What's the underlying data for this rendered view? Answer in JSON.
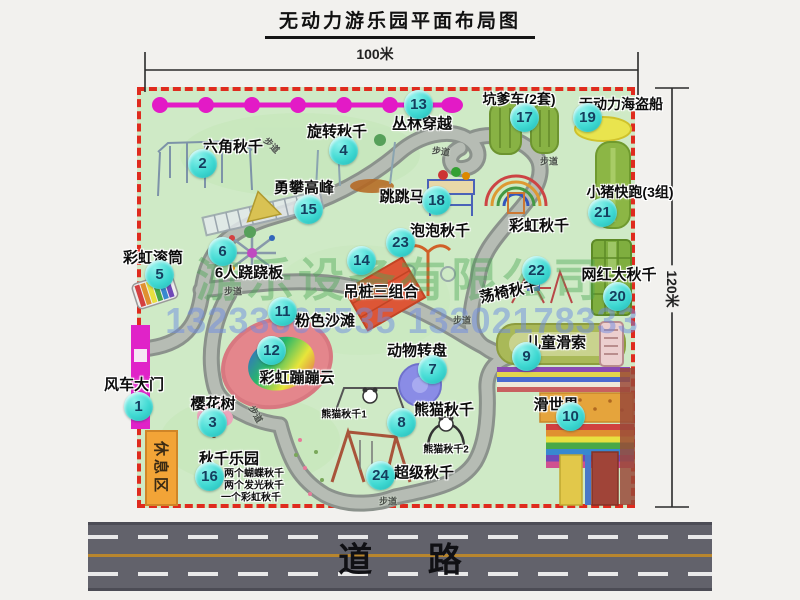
{
  "title": "无动力游乐园平面布局图",
  "dimensions": {
    "width_label": "100米",
    "height_label": "120米"
  },
  "road_label": "道 路",
  "rest_area_label": "休息区",
  "watermark": {
    "company": "游乐设备有限公司",
    "phone": "13233805535 13202178333"
  },
  "attractions": [
    {
      "num": "1",
      "name": "风车大门",
      "bx": 139,
      "by": 407,
      "lx": 134,
      "ly": 384
    },
    {
      "num": "2",
      "name": "六角秋千",
      "bx": 203,
      "by": 164,
      "lx": 233,
      "ly": 146
    },
    {
      "num": "3",
      "name": "樱花树",
      "bx": 213,
      "by": 423,
      "lx": 213,
      "ly": 403
    },
    {
      "num": "4",
      "name": "旋转秋千",
      "bx": 344,
      "by": 151,
      "lx": 337,
      "ly": 131
    },
    {
      "num": "5",
      "name": "彩虹滚筒",
      "bx": 160,
      "by": 275,
      "lx": 153,
      "ly": 257
    },
    {
      "num": "6",
      "name": "6人跷跷板",
      "bx": 223,
      "by": 252,
      "lx": 249,
      "ly": 272
    },
    {
      "num": "7",
      "name": "动物转盘",
      "bx": 433,
      "by": 370,
      "lx": 417,
      "ly": 350
    },
    {
      "num": "8",
      "name": "熊猫秋千",
      "bx": 402,
      "by": 423,
      "lx": 444,
      "ly": 409
    },
    {
      "num": "9",
      "name": "儿童滑索",
      "bx": 527,
      "by": 357,
      "lx": 556,
      "ly": 342
    },
    {
      "num": "10",
      "name": "滑世界",
      "bx": 571,
      "by": 417,
      "lx": 556,
      "ly": 404
    },
    {
      "num": "11",
      "name": "粉色沙滩",
      "bx": 283,
      "by": 312,
      "lx": 325,
      "ly": 320
    },
    {
      "num": "12",
      "name": "彩虹蹦蹦云",
      "bx": 272,
      "by": 351,
      "lx": 297,
      "ly": 377
    },
    {
      "num": "13",
      "name": "丛林穿越",
      "bx": 419,
      "by": 105,
      "lx": 422,
      "ly": 123
    },
    {
      "num": "14",
      "name": "吊桩三组合",
      "bx": 362,
      "by": 261,
      "lx": 381,
      "ly": 291
    },
    {
      "num": "15",
      "name": "勇攀高峰",
      "bx": 309,
      "by": 210,
      "lx": 304,
      "ly": 187
    },
    {
      "num": "16",
      "name": "秋千乐园",
      "bx": 210,
      "by": 477,
      "lx": 229,
      "ly": 458
    },
    {
      "num": "17",
      "name": "坑爹车(2套)",
      "bx": 525,
      "by": 118,
      "lx": 519,
      "ly": 99,
      "lsize": 14
    },
    {
      "num": "18",
      "name": "跳跳马",
      "bx": 437,
      "by": 201,
      "lx": 402,
      "ly": 196
    },
    {
      "num": "19",
      "name": "无动力海盗船",
      "bx": 588,
      "by": 118,
      "lx": 621,
      "ly": 104,
      "lsize": 14
    },
    {
      "num": "20",
      "name": "网红大秋千",
      "bx": 618,
      "by": 297,
      "lx": 619,
      "ly": 274
    },
    {
      "num": "21",
      "name": "小猪快跑(3组)",
      "bx": 603,
      "by": 213,
      "lx": 630,
      "ly": 192,
      "lsize": 14
    },
    {
      "num": "22",
      "name": "荡椅秋千",
      "bx": 537,
      "by": 271,
      "lx": 509,
      "ly": 291,
      "lrot": -12
    },
    {
      "num": "23",
      "name": "泡泡秋千",
      "bx": 401,
      "by": 243,
      "lx": 440,
      "ly": 230
    },
    {
      "num": "24",
      "name": "超级秋千",
      "bx": 381,
      "by": 476,
      "lx": 424,
      "ly": 472
    }
  ],
  "extra_labels": [
    {
      "text": "彩虹秋千",
      "x": 539,
      "y": 225,
      "size": 15
    },
    {
      "text": "熊猫秋千1",
      "x": 344,
      "y": 413,
      "size": 10
    },
    {
      "text": "熊猫秋千2",
      "x": 446,
      "y": 448,
      "size": 10
    },
    {
      "text": "两个蝴蝶秋千",
      "x": 254,
      "y": 472,
      "size": 10
    },
    {
      "text": "两个发光秋千",
      "x": 254,
      "y": 484,
      "size": 10
    },
    {
      "text": "一个彩虹秋千",
      "x": 251,
      "y": 496,
      "size": 10
    }
  ],
  "path_labels": [
    {
      "text": "步道",
      "x": 272,
      "y": 145,
      "rot": 45
    },
    {
      "text": "步道",
      "x": 441,
      "y": 151,
      "rot": 8
    },
    {
      "text": "步道",
      "x": 549,
      "y": 161,
      "rot": 0
    },
    {
      "text": "步道",
      "x": 233,
      "y": 291,
      "rot": 0
    },
    {
      "text": "步道",
      "x": 462,
      "y": 320,
      "rot": 0
    },
    {
      "text": "步道",
      "x": 256,
      "y": 414,
      "rot": 60
    },
    {
      "text": "步道",
      "x": 388,
      "y": 501,
      "rot": 0
    }
  ],
  "colors": {
    "map_green": "#cfeac6",
    "border_red": "#df2b1e",
    "badge_cyan": "#3fd9d2",
    "magenta": "#e31ac6",
    "road_gray": "#62626b",
    "rest_orange": "#f2a437"
  }
}
